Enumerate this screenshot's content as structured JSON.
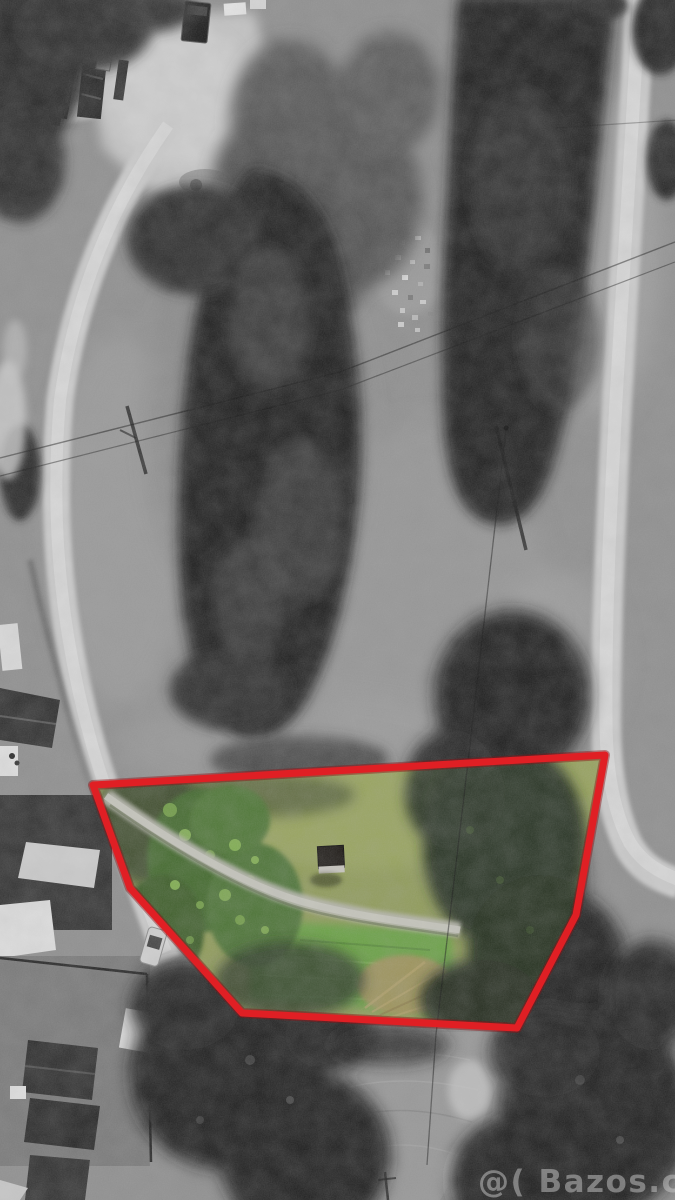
{
  "watermark": {
    "text": "@( Bazos.cz",
    "color": "#c9c9c9"
  },
  "parcel": {
    "polygon_points": "93,785 605,755 576,915 517,1028 242,1013 130,888",
    "outline_color": "#e01f24",
    "outline_shadow_color": "#8e1013",
    "outline_width": 7
  },
  "palette": {
    "field_gray": "#8e8e8e",
    "road_gray": "#cdcdcd",
    "road_core": "#dcdcdc",
    "tree_dark": "#1d1d1d",
    "grass_olive": "#8f9b58",
    "grass_mown": "#67a143",
    "foliage_green": "#41672b",
    "shadow_green": "#273122",
    "hay_tan": "#a3925d",
    "path_gray": "#b8b8ae",
    "stubble_gray": "#979797",
    "farmyard_gray": "#c4c4c4"
  }
}
